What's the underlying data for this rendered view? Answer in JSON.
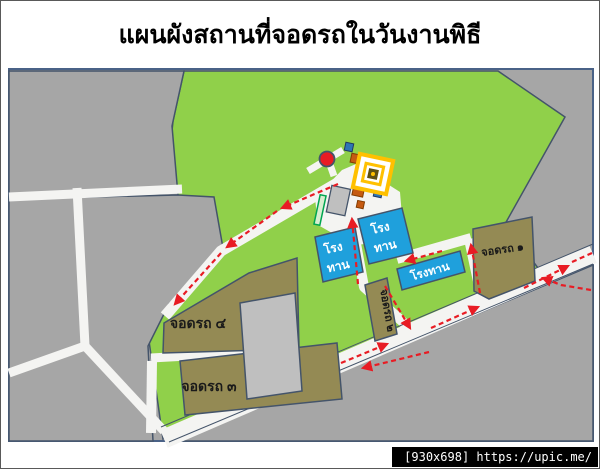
{
  "page": {
    "title": "แผนผังสถานที่จอดรถในวันงานพิธี",
    "watermark": "[930x698] https://upic.me/"
  },
  "map": {
    "parking_lots": [
      {
        "id": "1",
        "label": "จอดรถ ๑"
      },
      {
        "id": "2",
        "label": "จอดรถ ๒"
      },
      {
        "id": "3",
        "label": "จอดรถ ๓"
      },
      {
        "id": "4",
        "label": "จอดรถ ๔"
      }
    ],
    "pavilions": [
      {
        "label": "โรงทาน",
        "line1": "โรง",
        "line2": "ทาน"
      },
      {
        "label": "โรงทาน",
        "line1": "โรง",
        "line2": "ทาน"
      },
      {
        "label": "โรงทาน"
      }
    ],
    "landmarks": [
      {
        "icon": "temple-icon"
      },
      {
        "icon": "red-circle-marker"
      }
    ],
    "colors": {
      "field_green": "#90d04a",
      "background_gray": "#a6a6a6",
      "building_gray": "#bfbfbf",
      "road_white": "#f4f4f2",
      "parking_brown": "#948a54",
      "pavilion_blue": "#1fa0dc",
      "route_red": "#e81c24",
      "outline_blue": "#44546a",
      "temple_gold": "#ffc000"
    }
  }
}
